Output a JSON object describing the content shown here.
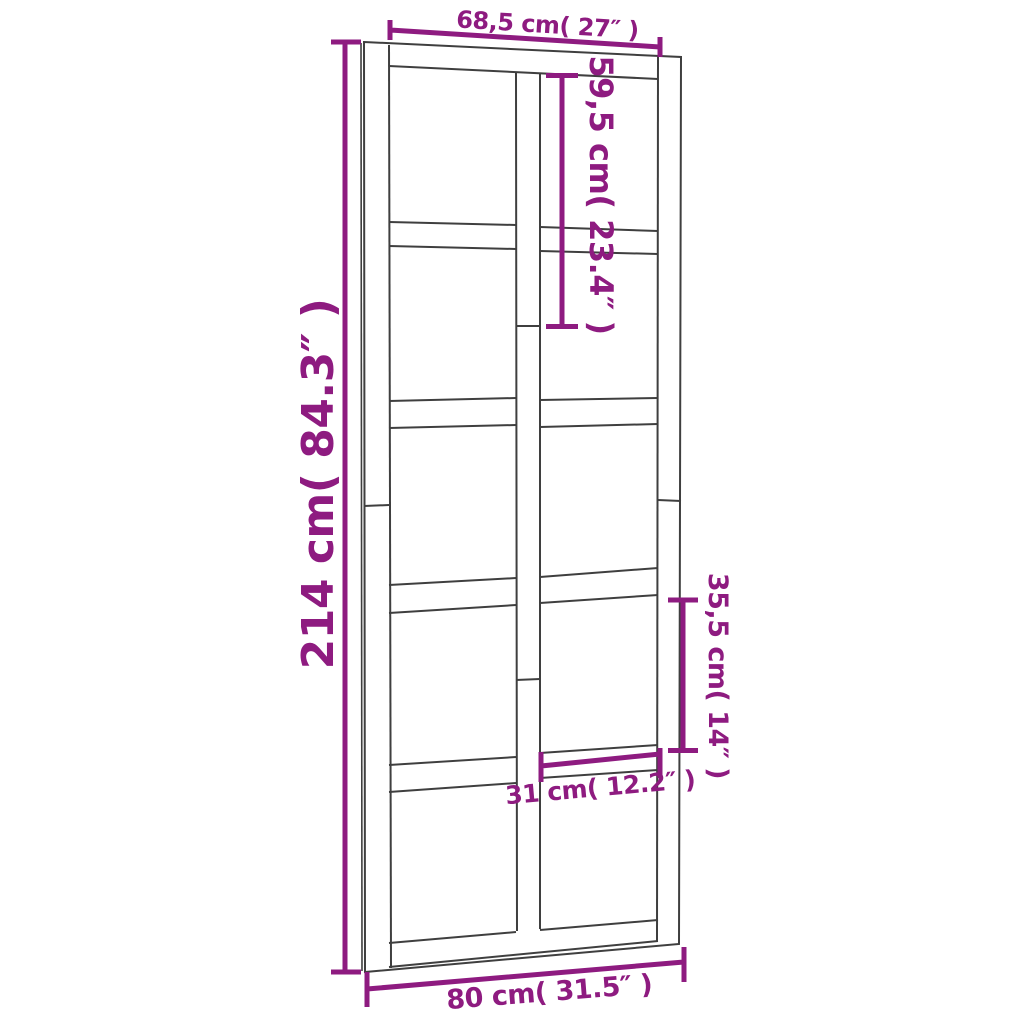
{
  "colors": {
    "dimension_accent": "#8e1b80",
    "door_line": "#3f3f3f",
    "background": "#ffffff"
  },
  "door": {
    "kind": "paneled-barn-door",
    "pane_grid": "2 columns x 5 rows"
  },
  "dimensions": {
    "inner_width_top": {
      "label": "68,5 cm( 27″ )",
      "cm": "68,5",
      "inches": "27"
    },
    "overall_height": {
      "label": "214 cm( 84.3″ )",
      "cm": "214",
      "inches": "84.3"
    },
    "upper_section_height": {
      "label": "59,5 cm( 23.4″ )",
      "cm": "59,5",
      "inches": "23.4"
    },
    "pane_height": {
      "label": "35,5 cm( 14″ )",
      "cm": "35,5",
      "inches": "14"
    },
    "pane_width": {
      "label": "31 cm( 12.2″ )",
      "cm": "31",
      "inches": "12.2"
    },
    "overall_width": {
      "label": "80 cm( 31.5″ )",
      "cm": "80",
      "inches": "31.5"
    }
  }
}
